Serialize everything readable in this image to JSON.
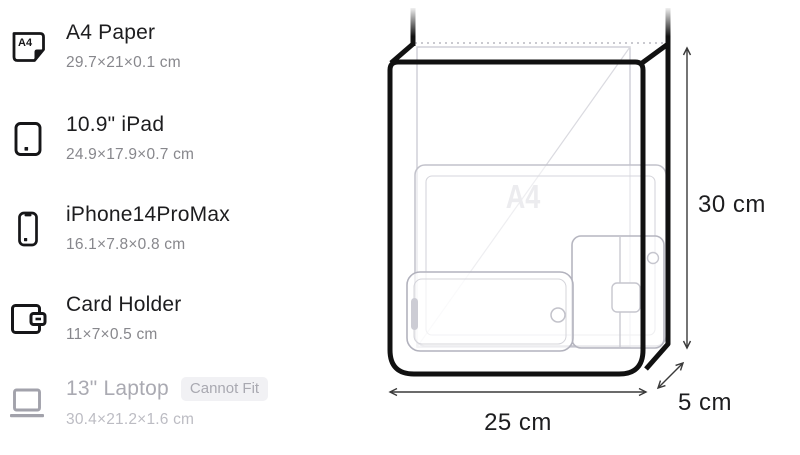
{
  "item_list": {
    "items": [
      {
        "title": "A4 Paper",
        "dimensions": "29.7×21×0.1 cm"
      },
      {
        "title": "10.9\" iPad",
        "dimensions": "24.9×17.9×0.7 cm"
      },
      {
        "title": "iPhone14ProMax",
        "dimensions": "16.1×7.8×0.8 cm"
      },
      {
        "title": "Card Holder",
        "dimensions": "11×7×0.5 cm"
      },
      {
        "title": "13\" Laptop",
        "dimensions": "30.4×21.2×1.6 cm",
        "badge": "Cannot Fit"
      }
    ],
    "a4_icon_label": "A4"
  },
  "diagram": {
    "watermark": "A4",
    "width_label": "25 cm",
    "height_label": "30 cm",
    "depth_label": "5 cm",
    "bag_dimensions_cm": {
      "width": 25,
      "height": 30,
      "depth": 5
    }
  },
  "colors": {
    "outline": "#111111",
    "item_gray": "#c2c2cb",
    "disabled_text": "#aaaab2",
    "badge_bg": "#f1f1f4",
    "badge_text": "#a9a9b1",
    "dimension_line": "#3a3a3a"
  }
}
